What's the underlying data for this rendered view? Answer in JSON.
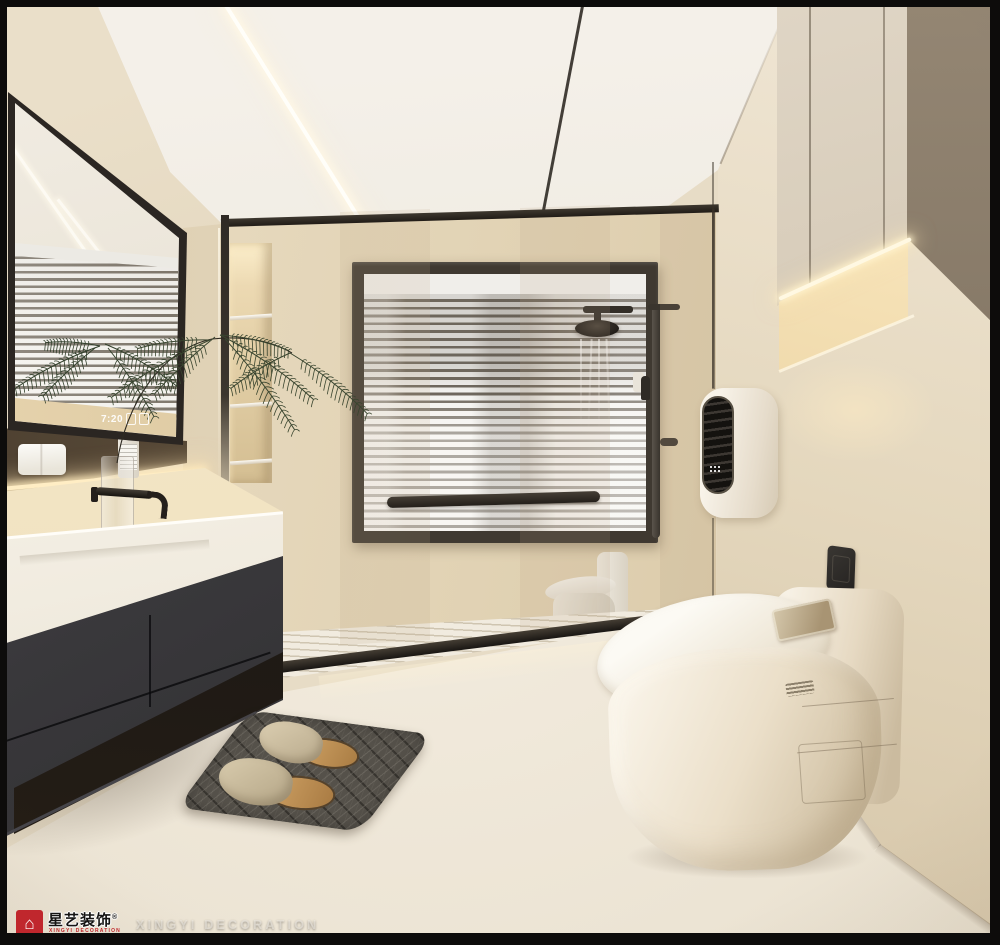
{
  "scene": {
    "description": "Modern cream minimalist bathroom interior render",
    "room": "bathroom"
  },
  "mirror": {
    "clock_time": "7:20"
  },
  "watermark": {
    "logo_icon": "xingyi-house-logo",
    "logo_glyph": "⌂",
    "logo_cn": "星艺装饰",
    "logo_tm": "®",
    "logo_sub_line": "XINGYI DECORATION",
    "brand_text": "XINGYI DECORATION"
  },
  "palette": {
    "accent_red": "#C0272D",
    "frame_black": "#0D0C0B",
    "ceiling": "#F2EDE5",
    "wall_cream": "#E9DECA",
    "wall_warm": "#DFD1B4",
    "counter_white": "#F6F2EA",
    "cabinet_charcoal": "#39383B",
    "window_frame": "#3F3931",
    "floor_cream": "#EFE8DB",
    "mat_gray": "#56524B",
    "slipper_tan": "#CBBB9E",
    "cork_tan": "#BE8F52",
    "glow_warm": "#FFEDC4",
    "plant_green": "#39452F",
    "toilet_white": "#F6F0E4"
  }
}
